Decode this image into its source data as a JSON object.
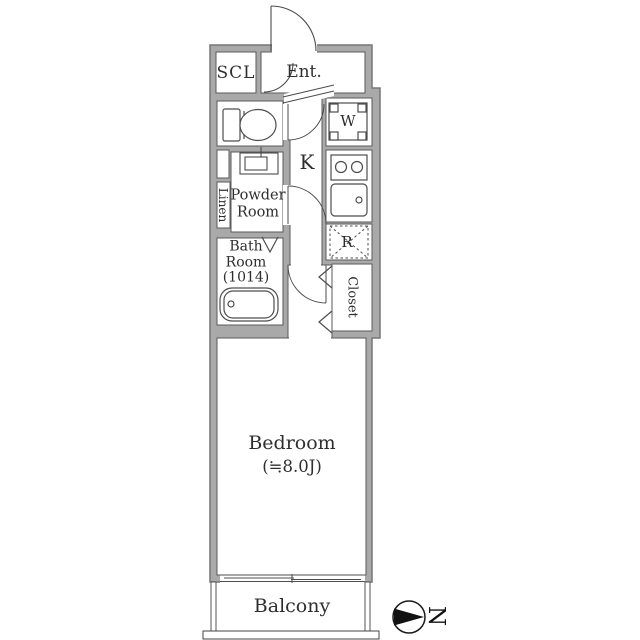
{
  "floorplan": {
    "labels": {
      "scl": "SCL",
      "entrance": "Ent.",
      "kitchen": "K",
      "washing_machine": "W",
      "refrigerator": "R",
      "powder_line1": "Powder",
      "powder_line2": "Room",
      "linen": "Linen",
      "bath_line1": "Bath",
      "bath_line2": "Room",
      "bath_line3": "(1014)",
      "closet": "Closet",
      "bedroom_name": "Bedroom",
      "bedroom_size": "(≒8.0J)",
      "balcony": "Balcony",
      "compass_north": "N"
    },
    "colors": {
      "wall_fill": "#a9a9a9",
      "wall_outline": "#777777",
      "fixture_line": "#4d4d4d",
      "text": "#2e2e2e"
    }
  }
}
